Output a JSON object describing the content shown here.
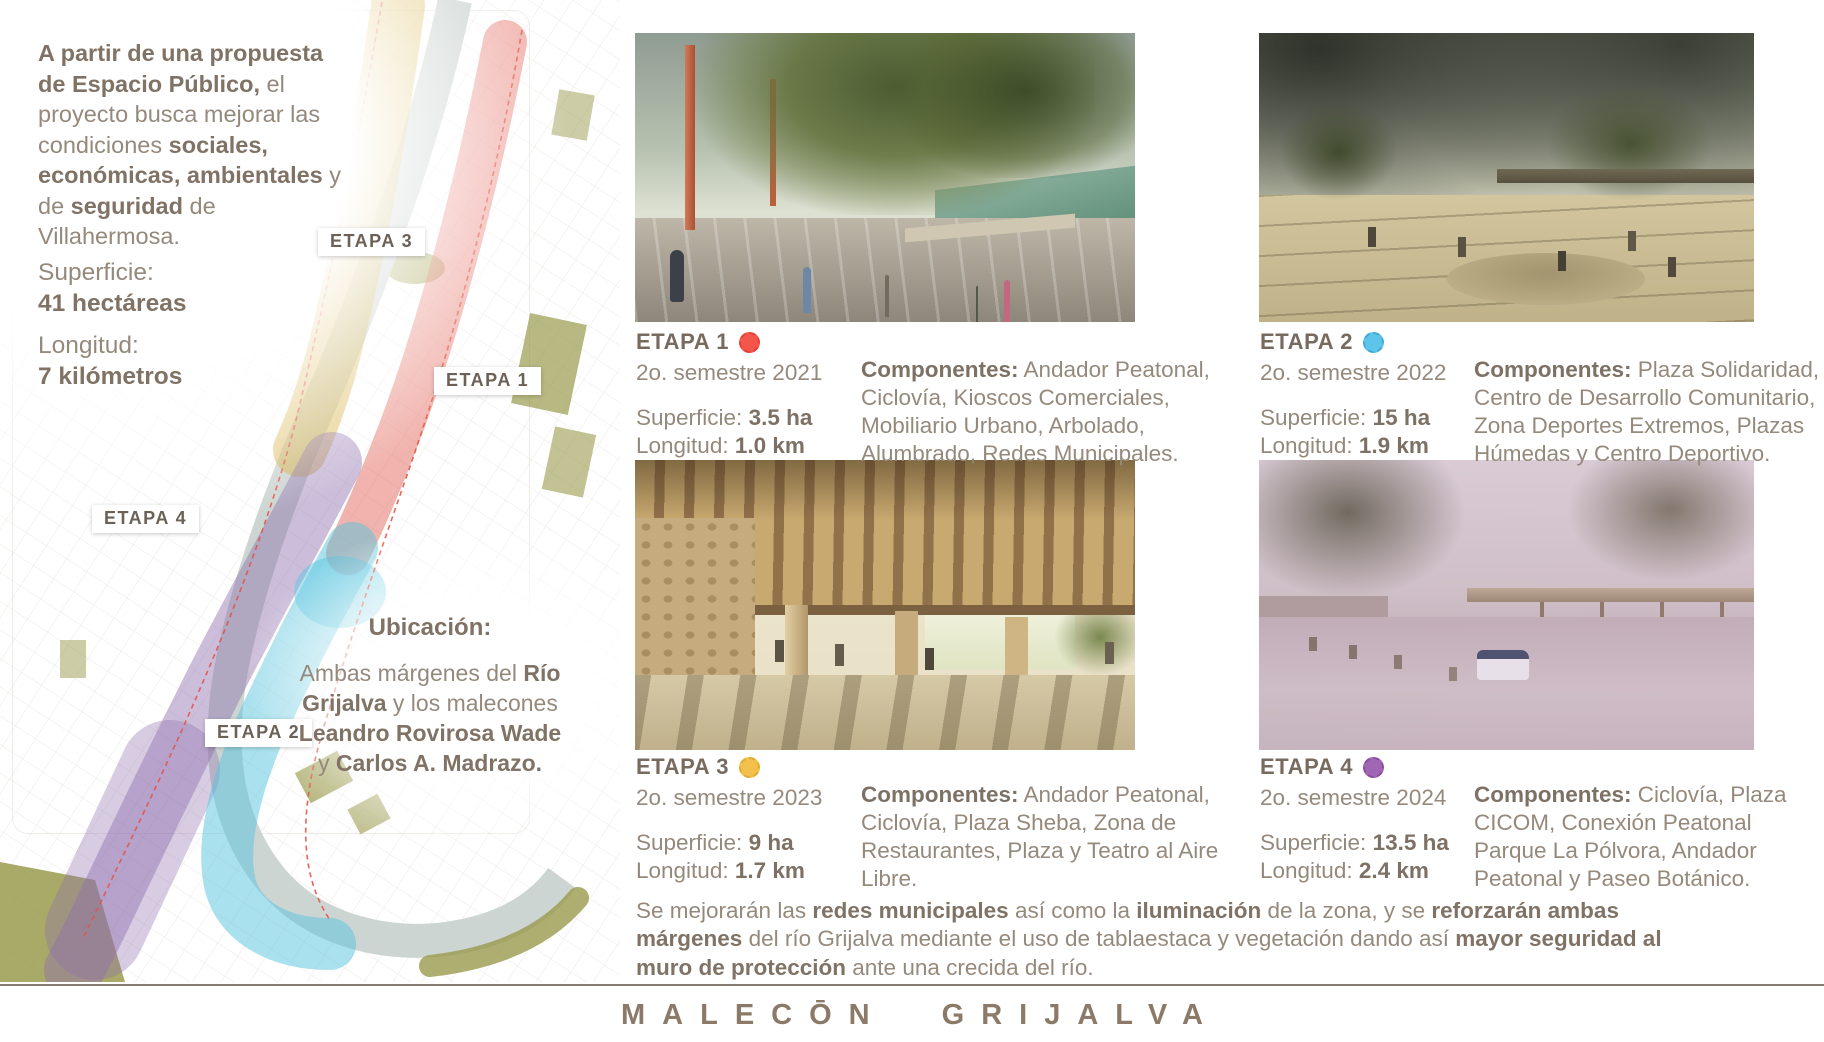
{
  "intro": {
    "b1": "A partir de una propuesta de Espacio Público,",
    "r1": " el proyecto busca mejorar las condiciones ",
    "b2": "sociales, económicas, ambientales",
    "r2": " y de ",
    "b3": "seguridad",
    "r3": " de Villahermosa."
  },
  "metrics": {
    "superficie_label": "Superficie:",
    "superficie_value": "41 hectáreas",
    "longitud_label": "Longitud:",
    "longitud_value": "7 kilómetros"
  },
  "ubicacion": {
    "title": "Ubicación:",
    "r1": "Ambas márgenes del ",
    "b1": "Río Grijalva",
    "r2": " y los malecones ",
    "b2": "Leandro Rovirosa Wade",
    "r3": " y ",
    "b3": "Carlos A. Madrazo."
  },
  "map": {
    "labels": {
      "etapa1": "ETAPA 1",
      "etapa2": "ETAPA 2",
      "etapa3": "ETAPA 3",
      "etapa4": "ETAPA 4"
    },
    "zone_colors": {
      "etapa1": "#e4685c",
      "etapa2": "#55c3de",
      "etapa3": "#d3ac3b",
      "etapa4": "#8f6fae",
      "river": "#cdd5d2",
      "green_areas": "#9a9a4d",
      "boundary_dashed": "#e05548"
    }
  },
  "etapas": [
    {
      "title": "ETAPA 1",
      "dot_color": "#f4564c",
      "semester": "2o. semestre 2021",
      "superficie_label": "Superficie:",
      "superficie": "3.5 ha",
      "longitud_label": "Longitud:",
      "longitud": "1.0 km",
      "componentes_label": "Componentes:",
      "componentes": " Andador Peatonal, Ciclovía, Kioscos Comerciales, Mobiliario Urbano, Arbolado, Alumbrado, Redes Municipales."
    },
    {
      "title": "ETAPA 2",
      "dot_color": "#5ec4ea",
      "semester": "2o. semestre 2022",
      "superficie_label": "Superficie:",
      "superficie": "15 ha",
      "longitud_label": "Longitud:",
      "longitud": "1.9 km",
      "componentes_label": "Componentes:",
      "componentes": " Plaza Solidaridad, Centro de Desarrollo Comunitario, Zona Deportes Extremos, Plazas Húmedas y Centro Deportivo."
    },
    {
      "title": "ETAPA 3",
      "dot_color": "#f3c04b",
      "semester": "2o. semestre 2023",
      "superficie_label": "Superficie:",
      "superficie": "9 ha",
      "longitud_label": "Longitud:",
      "longitud": "1.7 km",
      "componentes_label": "Componentes:",
      "componentes": " Andador Peatonal, Ciclovía, Plaza Sheba, Zona de Restaurantes, Plaza y Teatro al Aire Libre."
    },
    {
      "title": "ETAPA 4",
      "dot_color": "#a066b4",
      "semester": "2o. semestre 2024",
      "superficie_label": "Superficie:",
      "superficie": "13.5 ha",
      "longitud_label": "Longitud:",
      "longitud": "2.4 km",
      "componentes_label": "Componentes:",
      "componentes": " Ciclovía, Plaza CICOM, Conexión Peatonal Parque La Pólvora, Andador Peatonal y Paseo Botánico."
    }
  ],
  "note": {
    "r1": "Se mejorarán las ",
    "b1": "redes municipales",
    "r2": " así como la ",
    "b2": "iluminación",
    "r3": " de la zona, y se ",
    "b3": "reforzarán ambas márgenes",
    "r4": " del río Grijalva mediante el uso de tablaestaca y vegetación dando así ",
    "b4": "mayor seguridad al muro de protección",
    "r5": " ante una crecida del río."
  },
  "footer": {
    "title": "MALECŌN GRIJALVA"
  }
}
